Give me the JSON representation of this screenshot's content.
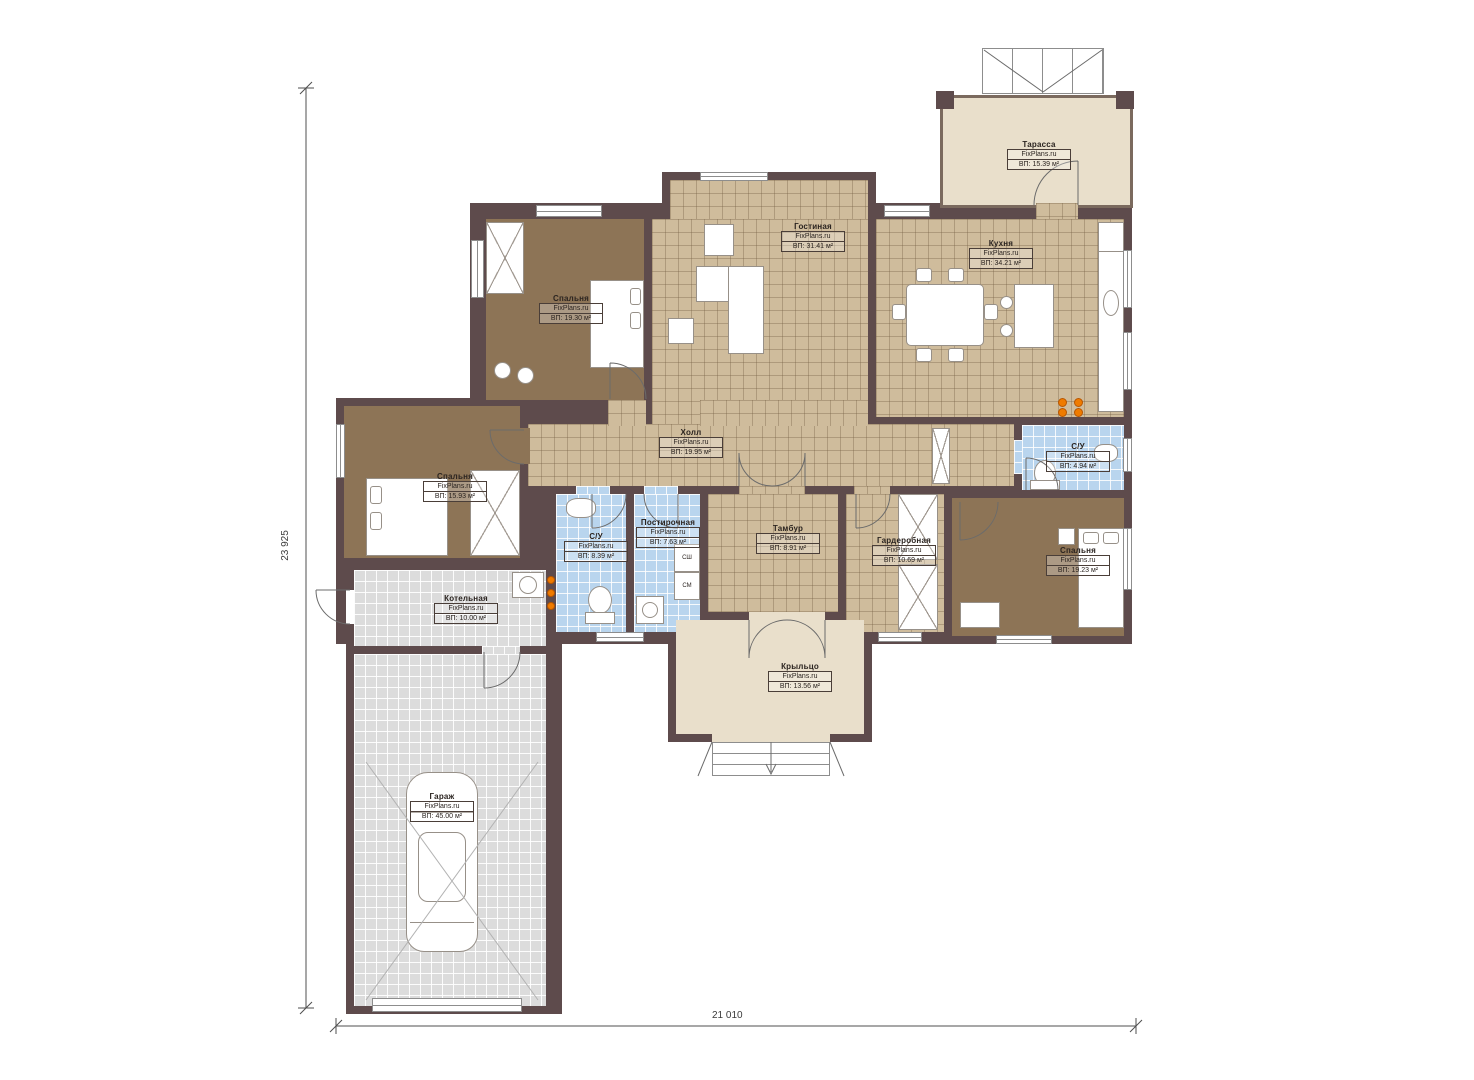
{
  "brand": "FixPlans.ru",
  "dimensions": {
    "left": "23 925",
    "bottom": "21 010"
  },
  "appliances": {
    "box1": "СШ",
    "box2": "СМ"
  },
  "rooms": {
    "terrace": {
      "name": "Тарасса",
      "area": "ВП: 15.39 м²"
    },
    "living": {
      "name": "Гостиная",
      "area": "ВП: 31.41 м²"
    },
    "kitchen": {
      "name": "Кухня",
      "area": "ВП: 34.21 м²"
    },
    "bedroom_top": {
      "name": "Спальня",
      "area": "ВП: 19.30 м²"
    },
    "hall": {
      "name": "Холл",
      "area": "ВП: 19.95 м²"
    },
    "bedroom_left": {
      "name": "Спальня",
      "area": "ВП: 15.93 м²"
    },
    "bathroom_left": {
      "name": "С/У",
      "area": "ВП: 8.39 м²"
    },
    "laundry": {
      "name": "Постирочная",
      "area": "ВП: 7.63 м²"
    },
    "vestibule": {
      "name": "Тамбур",
      "area": "ВП: 8.91 м²"
    },
    "wardrobe": {
      "name": "Гардеробная",
      "area": "ВП: 10.69 м²"
    },
    "bathroom_right": {
      "name": "С/У",
      "area": "ВП: 4.94 м²"
    },
    "bedroom_right": {
      "name": "Спальня",
      "area": "ВП: 19.23 м²"
    },
    "boiler": {
      "name": "Котельная",
      "area": "ВП: 10.00 м²"
    },
    "porch": {
      "name": "Крыльцо",
      "area": "ВП: 13.56 м²"
    },
    "garage": {
      "name": "Гараж",
      "area": "ВП: 45.00 м²"
    }
  },
  "colors": {
    "wall": "#5e4b4c",
    "floor_tan": "#cfbc9c",
    "floor_blue": "#b9d5ee",
    "floor_gray": "#dcdcdc",
    "floor_brown": "#8d7456",
    "floor_beige": "#e9dfcb",
    "accent_orange": "#ef7b00"
  }
}
